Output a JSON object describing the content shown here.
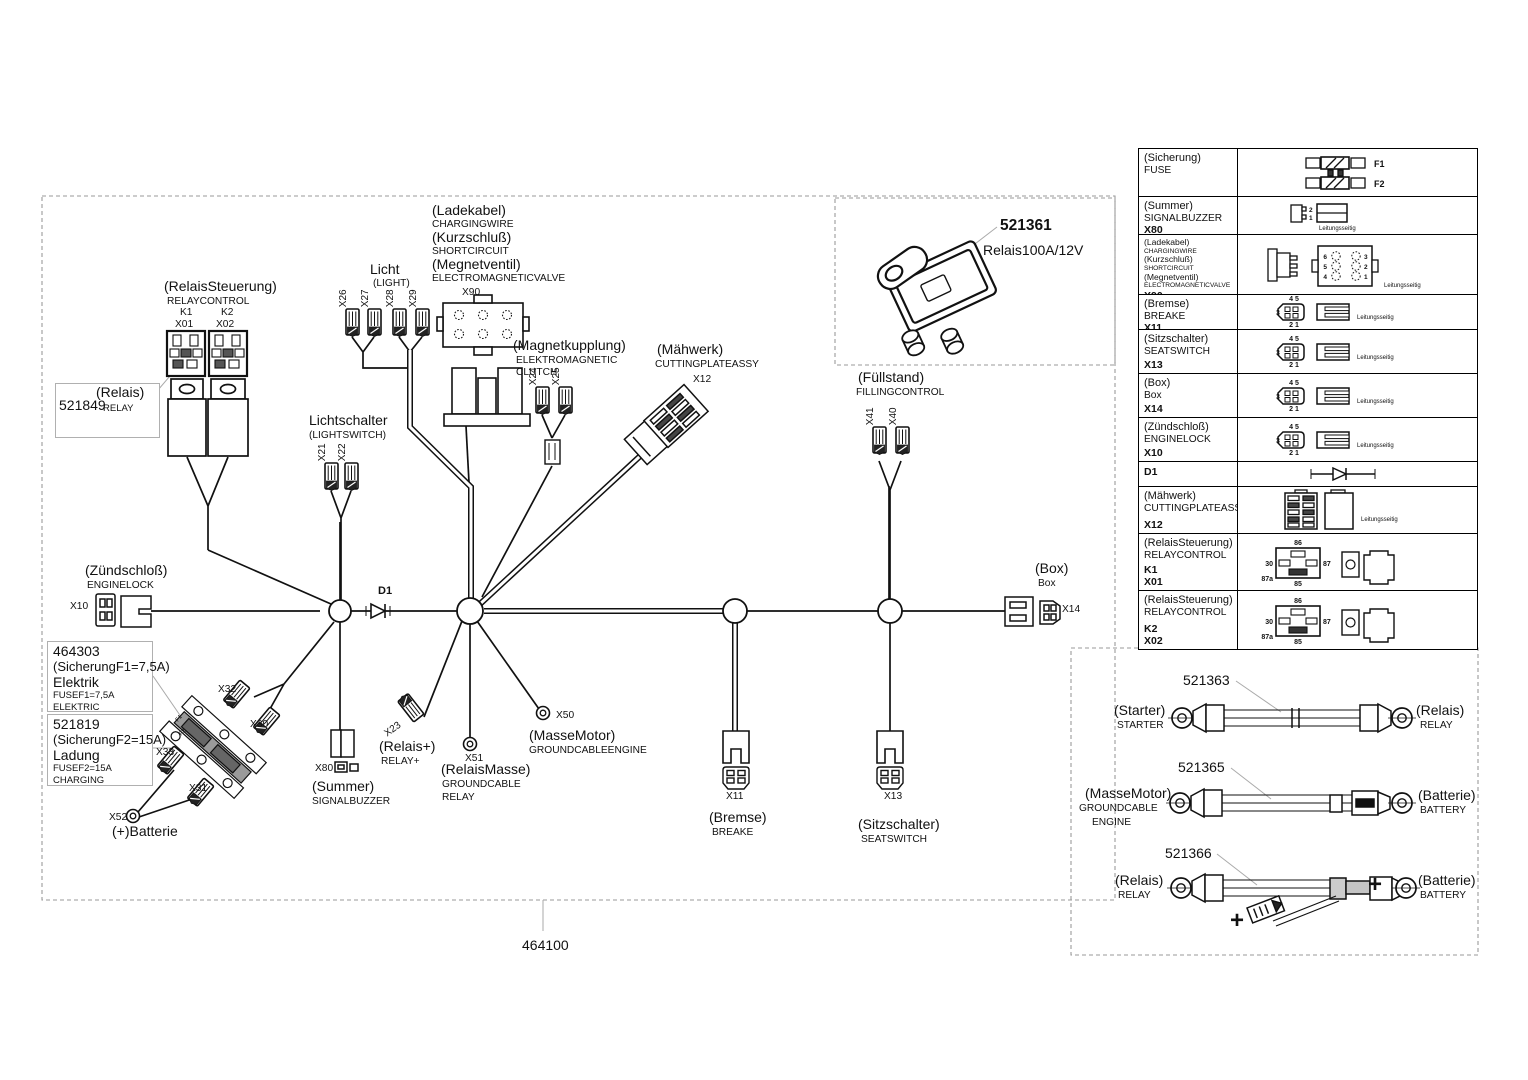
{
  "diagram": {
    "part_number": "464100",
    "relaycontrol": {
      "de": "(RelaisSteuerung)",
      "en": "RELAYCONTROL",
      "k1": "K1",
      "x01": "X01",
      "k2": "K2",
      "x02": "X02"
    },
    "relay_box": {
      "part": "521849",
      "de": "(Relais)",
      "en": "RELAY"
    },
    "light": {
      "de": "Licht",
      "en": "(LIGHT)",
      "c": [
        "X26",
        "X27",
        "X28",
        "X29"
      ]
    },
    "charging": {
      "l1": "(Ladekabel)",
      "l2": "CHARGINGWIRE",
      "l3": "(Kurzschluß)",
      "l4": "SHORTCIRCUIT",
      "l5": "(Megnetventil)",
      "l6": "ELECTROMAGNETICVALVE",
      "c": "X90"
    },
    "clutch": {
      "de": "(Magnetkupplung)",
      "en1": "ELEKTROMAGNETIC",
      "en2": "CLUTCH",
      "c": [
        "X24",
        "X25"
      ]
    },
    "lightswitch": {
      "de": "Lichtschalter",
      "en": "(LIGHTSWITCH)",
      "c": [
        "X21",
        "X22"
      ]
    },
    "cutting": {
      "de": "(Mähwerk)",
      "en": "CUTTINGPLATEASSY",
      "c": "X12"
    },
    "filling": {
      "de": "(Füllstand)",
      "en": "FILLINGCONTROL",
      "c": [
        "X41",
        "X40"
      ]
    },
    "enginelock": {
      "de": "(Zündschloß)",
      "en": "ENGINELOCK",
      "c": "X10"
    },
    "diode": "D1",
    "fuse1_box": {
      "part": "464303",
      "de1": "(SicherungF1=7,5A)",
      "de2": "Elektrik",
      "en1": "FUSEF1=7,5A",
      "en2": "ELEKTRIC"
    },
    "fuse2_box": {
      "part": "521819",
      "de1": "(SicherungF2=15A)",
      "de2": "Ladung",
      "en1": "FUSEF2=15A",
      "en2": "CHARGING"
    },
    "fuse_conn": [
      "X32",
      "X30",
      "X33",
      "X31"
    ],
    "battery": {
      "c": "X52",
      "de": "(+)Batterie"
    },
    "buzzer": {
      "c": "X80",
      "de": "(Summer)",
      "en": "SIGNALBUZZER"
    },
    "relay_plus": {
      "c": "X23",
      "de": "(Relais+)",
      "en": "RELAY+"
    },
    "ground_relay": {
      "c": "X51",
      "de": "(RelaisMasse)",
      "en1": "GROUNDCABLE",
      "en2": "RELAY"
    },
    "ground_engine": {
      "c": "X50",
      "de": "(MasseMotor)",
      "en": "GROUNDCABLEENGINE"
    },
    "brake": {
      "c": "X11",
      "de": "(Bremse)",
      "en": "BREAKE"
    },
    "seat": {
      "c": "X13",
      "de": "(Sitzschalter)",
      "en": "SEATSWITCH"
    },
    "box": {
      "c": "X14",
      "de": "(Box)",
      "en": "Box"
    }
  },
  "inset": {
    "part": "521361",
    "label": "Relais100A/12V"
  },
  "table": {
    "wire_side": "Leitungsseitig",
    "pins": {
      "f1": "F1",
      "f2": "F2",
      "p2": "2",
      "p1": "1",
      "p45": "4 5",
      "p3": "3",
      "p21": "2 1",
      "x6": "6",
      "x5": "5",
      "x4": "4",
      "x3": "3",
      "x2": "2",
      "x1": "1",
      "r86": "86",
      "r30": "30",
      "r87": "87",
      "r87a": "87a",
      "r85": "85"
    },
    "rows": [
      {
        "de": "(Sicherung)",
        "en": "FUSE"
      },
      {
        "de": "(Summer)",
        "en": "SIGNALBUZZER",
        "code": "X80"
      },
      {
        "l1": "(Ladekabel)",
        "l2": "CHARGINGWIRE",
        "l3": "(Kurzschluß)",
        "l4": "SHORTCIRCUIT",
        "l5": "(Megnetventil)",
        "l6": "ELECTROMAGNETICVALVE",
        "code": "X90"
      },
      {
        "de": "(Bremse)",
        "en": "BREAKE",
        "code": "X11"
      },
      {
        "de": "(Sitzschalter)",
        "en": "SEATSWITCH",
        "code": "X13"
      },
      {
        "de": "(Box)",
        "en": "Box",
        "code": "X14"
      },
      {
        "de": "(Zündschloß)",
        "en": "ENGINELOCK",
        "code": "X10"
      },
      {
        "code": "D1"
      },
      {
        "de": "(Mähwerk)",
        "en": "CUTTINGPLATEASSY",
        "code": "X12"
      },
      {
        "de": "(RelaisSteuerung)",
        "en": "RELAYCONTROL",
        "code": "K1",
        "code2": "X01"
      },
      {
        "de": "(RelaisSteuerung)",
        "en": "RELAYCONTROL",
        "code": "K2",
        "code2": "X02"
      }
    ]
  },
  "cables": [
    {
      "part": "521363",
      "left_de": "(Starter)",
      "left_en": "STARTER",
      "right_de": "(Relais)",
      "right_en": "RELAY"
    },
    {
      "part": "521365",
      "left_de": "(MasseMotor)",
      "left_en1": "GROUNDCABLE",
      "left_en2": "ENGINE",
      "right_de": "(Batterie)",
      "right_en": "BATTERY"
    },
    {
      "part": "521366",
      "left_de": "(Relais)",
      "left_en": "RELAY",
      "right_de": "(Batterie)",
      "right_en": "BATTERY",
      "plus": "+"
    }
  ]
}
